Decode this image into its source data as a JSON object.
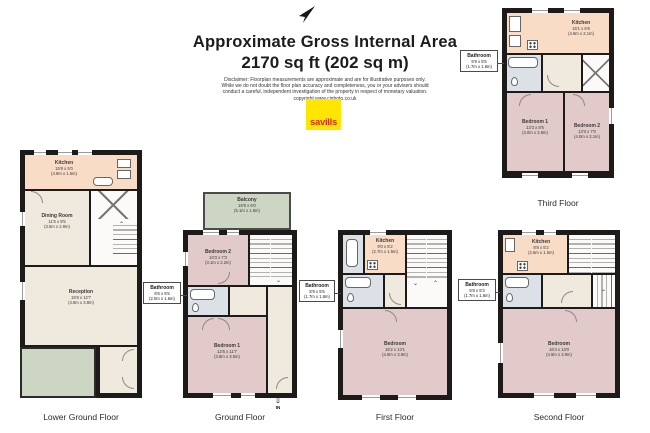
{
  "header": {
    "title_line1": "Approximate Gross Internal Area",
    "title_line2": "2170 sq ft (202 sq m)",
    "disclaimer": [
      "Disclaimer: Floorplan measurements are approximate and are for illustrative purposes only.",
      "While we do not doubt the floor plan accuracy and completeness, you or your advisers should",
      "conduct a careful, independent investigation of the property in respect of monetary valuation.",
      "copyright www.cjphoto.co.uk"
    ],
    "logo_text": "savills",
    "north_icon": "north-arrow"
  },
  "colors": {
    "wall": "#1d1b19",
    "floor_cream": "#f0e9dd",
    "kitchen_peach": "#f8dcc5",
    "bedroom_pink": "#e2c9ca",
    "bathroom_blue": "#dce1e7",
    "outdoor_green": "#ccd6c3",
    "logo_yellow": "#FFE600",
    "logo_red": "#d42c21"
  },
  "floors": {
    "lower_ground": {
      "caption": "Lower Ground Floor",
      "rooms": {
        "kitchen": {
          "name": "Kitchen",
          "ft": "15'8 x 5'0",
          "m": "(4.8m x 1.5m)"
        },
        "dining_room": {
          "name": "Dining Room",
          "ft": "11'5 x 9'5",
          "m": "(3.5m x 2.9m)"
        },
        "reception": {
          "name": "Reception",
          "ft": "15'8 x 12'7",
          "m": "(4.8m x 3.8m)"
        }
      }
    },
    "ground": {
      "caption": "Ground Floor",
      "entry_label": "IN",
      "rooms": {
        "balcony": {
          "name": "Balcony",
          "ft": "16'8 x 6'0",
          "m": "(5.1m x 1.8m)"
        },
        "bedroom2": {
          "name": "Bedroom 2",
          "ft": "10'3 x 7'3",
          "m": "(3.1m x 2.2m)"
        },
        "bathroom": {
          "name": "Bathroom",
          "ft": "6'6 x 5'5",
          "m": "(2.0m x 1.6m)"
        },
        "bedroom1": {
          "name": "Bedroom 1",
          "ft": "12'6 x 11'7",
          "m": "(3.8m x 3.5m)"
        }
      }
    },
    "first": {
      "caption": "First Floor",
      "rooms": {
        "kitchen": {
          "name": "Kitchen",
          "ft": "9'0 x 5'2",
          "m": "(2.7m x 1.5m)"
        },
        "bathroom": {
          "name": "Bathroom",
          "ft": "5'9 x 5'5",
          "m": "(1.7m x 1.6m)"
        },
        "bedroom": {
          "name": "Bedroom",
          "ft": "16'2 x 13'1",
          "m": "(4.9m x 3.9m)"
        }
      }
    },
    "second": {
      "caption": "Second Floor",
      "rooms": {
        "kitchen": {
          "name": "Kitchen",
          "ft": "8'8 x 5'2",
          "m": "(2.6m x 1.5m)"
        },
        "bathroom": {
          "name": "Bathroom",
          "ft": "5'8 x 5'3",
          "m": "(1.7m x 1.6m)"
        },
        "bedroom": {
          "name": "Bedroom",
          "ft": "16'4 x 13'0",
          "m": "(4.9m x 3.9m)"
        }
      }
    },
    "third": {
      "caption": "Third Floor",
      "rooms": {
        "kitchen": {
          "name": "Kitchen",
          "ft": "16'1 x 6'9",
          "m": "(4.9m x 2.1m)"
        },
        "bathroom": {
          "name": "Bathroom",
          "ft": "5'9 x 5'5",
          "m": "(1.7m x 1.6m)"
        },
        "bedroom1": {
          "name": "Bedroom 1",
          "ft": "13'3 x 8'6",
          "m": "(4.0m x 2.6m)"
        },
        "bedroom2": {
          "name": "Bedroom 2",
          "ft": "13'3 x 7'0",
          "m": "(4.0m x 2.1m)"
        }
      }
    }
  }
}
